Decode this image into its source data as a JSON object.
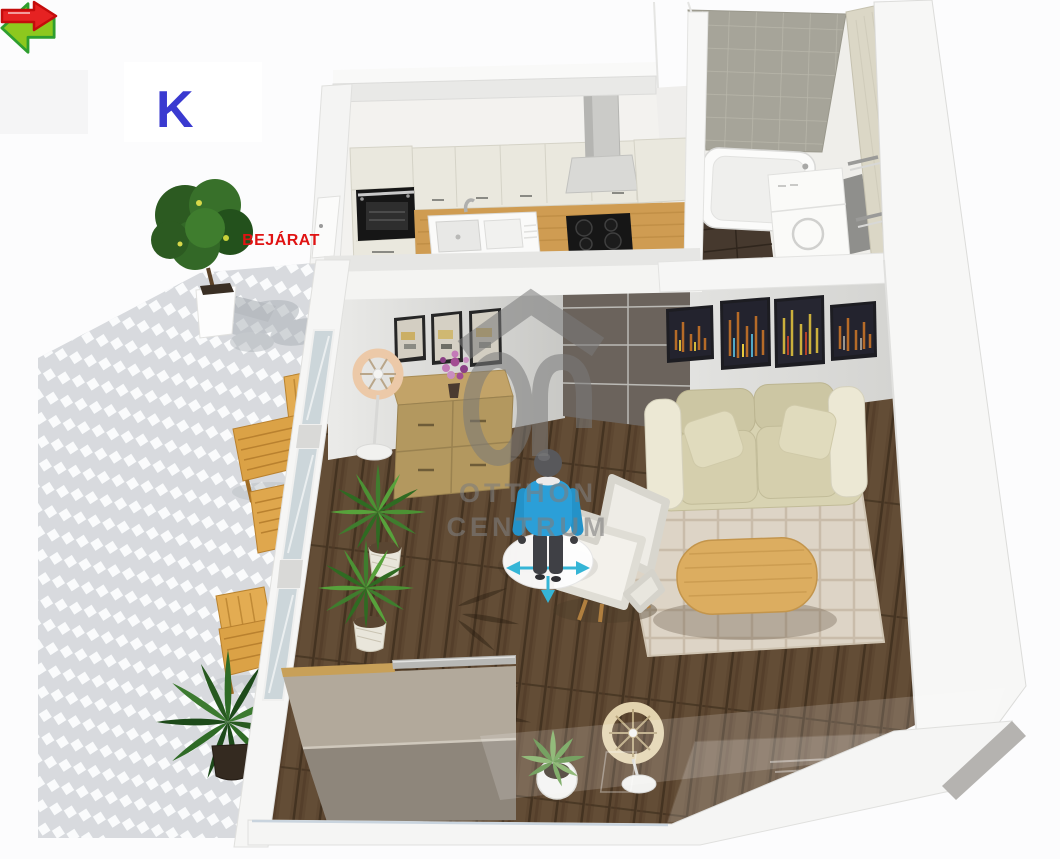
{
  "scene": {
    "agency_watermark": {
      "line1": "OTTHON",
      "line2": "CENTRUM",
      "color": "#787878"
    },
    "compass": {
      "label": "K",
      "label_color": "#3a3ad0",
      "arrow_fill": "#8dc81e",
      "arrow_stroke": "#2e9e2e",
      "direction": "left"
    },
    "entrance": {
      "label": "BEJÁRAT",
      "label_color": "#e01313",
      "arrow_fill": "#e62222",
      "arrow_stroke": "#c40c0c",
      "direction": "right"
    }
  },
  "palette": {
    "background": "#fcfcfd",
    "wall": "#f6f6f5",
    "wall_top": "#e7e7e5",
    "wood_floor": "#5d4731",
    "paving_joint": "#d8dade",
    "paving_brick": "#fafbfc",
    "hall_tile": "#6b635c",
    "kitchen_cabinet": "#eae8de",
    "countertop": "#cf9c52",
    "appliance_black": "#161616",
    "bath_wall_tile": "#a6a499",
    "bath_side_tile": "#dbd7c6",
    "bath_floor": "#46392e",
    "sofa": "#d8d3b2",
    "sofa_cushion": "#ccc6a3",
    "rug": "#ddd4c6",
    "coffee_table": "#dcad60",
    "dresser": "#b3985f",
    "armchair": "#efede7",
    "cabinet_top": "#b2a99b",
    "cabinet_front": "#8e867b",
    "plant_green": "#3f7d2e",
    "terrace_wood": "#dba54b"
  },
  "figure": {
    "shirt": "#2b9fd8",
    "pants": "#3f4045",
    "nav_ring": "#ffffff",
    "nav_arrows": "#35b5d6"
  }
}
